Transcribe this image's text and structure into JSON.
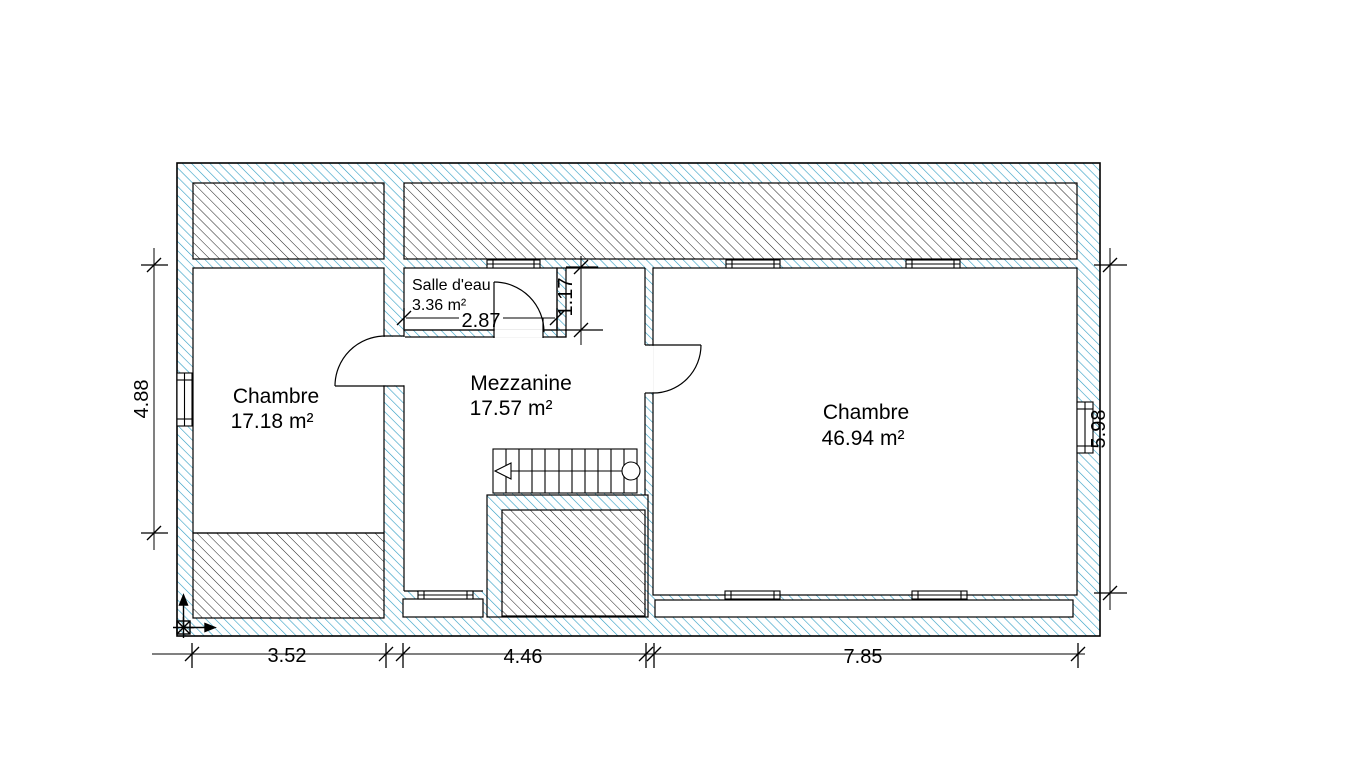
{
  "plan": {
    "rooms": [
      {
        "name": "Chambre",
        "area": "17.18 m²"
      },
      {
        "name": "Mezzanine",
        "area": "17.57 m²"
      },
      {
        "name": "Salle d'eau",
        "area": "3.36 m²"
      },
      {
        "name": "Chambre",
        "area": "46.94 m²"
      }
    ],
    "dimensions": {
      "bottom": [
        "3.52",
        "4.46",
        "7.85"
      ],
      "left": "4.88",
      "right": "5.98",
      "salle_width": "2.87",
      "salle_height": "1.17"
    },
    "colors": {
      "wall_hatch": "#2e9dc3",
      "slope_hatch": "#1f1f1f",
      "line": "#000000"
    }
  }
}
